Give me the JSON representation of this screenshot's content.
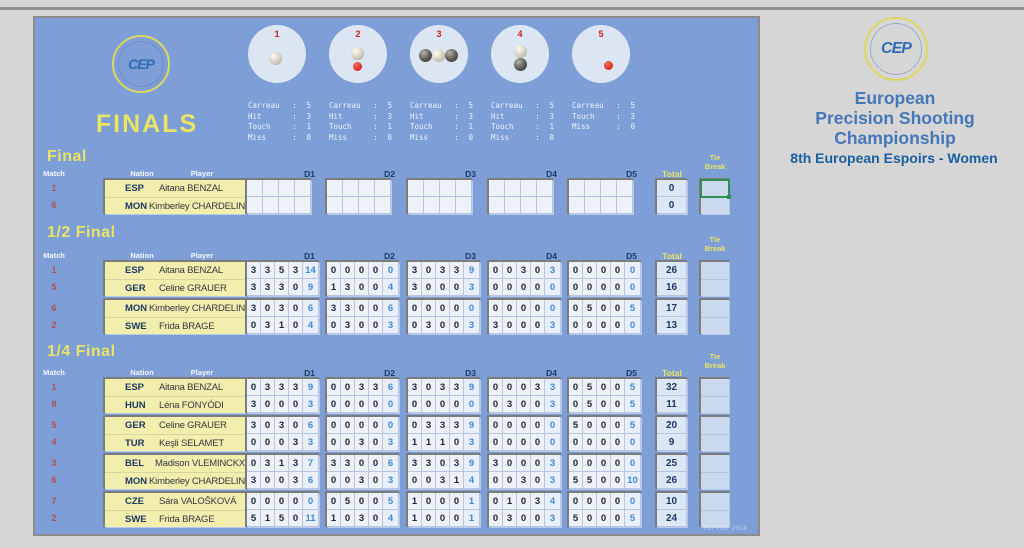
{
  "window": {
    "watermark": "MJPYGG_2024"
  },
  "board": {
    "title": "FINALS",
    "logo_text": "CEP"
  },
  "colors": {
    "board_bg": "#7d9ed6",
    "accent_yellow": "#e9e464",
    "navy": "#1f3864",
    "score_blue": "#4088d8",
    "match_red": "#b25050",
    "selection_green": "#2f8f4f",
    "player_bg": "#f2efae"
  },
  "targets": {
    "circles": [
      {
        "number": "1",
        "balls": [
          {
            "type": "light",
            "dx": -2,
            "dy": 4
          }
        ],
        "stats": [
          [
            "Carreau",
            "5"
          ],
          [
            "Hit",
            "3"
          ],
          [
            "Touch",
            "1"
          ],
          [
            "Miss",
            "0"
          ]
        ]
      },
      {
        "number": "2",
        "balls": [
          {
            "type": "light",
            "dx": -1,
            "dy": -1
          },
          {
            "type": "jack",
            "dx": -1,
            "dy": 12
          }
        ],
        "stats": [
          [
            "Carreau",
            "5"
          ],
          [
            "Hit",
            "3"
          ],
          [
            "Touch",
            "1"
          ],
          [
            "Miss",
            "0"
          ]
        ]
      },
      {
        "number": "3",
        "balls": [
          {
            "type": "dark",
            "dx": -14,
            "dy": 1
          },
          {
            "type": "dark",
            "dx": 12,
            "dy": 1
          },
          {
            "type": "light",
            "dx": -1,
            "dy": 1
          }
        ],
        "stats": [
          [
            "Carreau",
            "5"
          ],
          [
            "Hit",
            "3"
          ],
          [
            "Touch",
            "1"
          ],
          [
            "Miss",
            "0"
          ]
        ]
      },
      {
        "number": "4",
        "balls": [
          {
            "type": "light",
            "dx": 0,
            "dy": -3
          },
          {
            "type": "dark",
            "dx": 0,
            "dy": 10
          }
        ],
        "stats": [
          [
            "Carreau",
            "5"
          ],
          [
            "Hit",
            "3"
          ],
          [
            "Touch",
            "1"
          ],
          [
            "Miss",
            "0"
          ]
        ]
      },
      {
        "number": "5",
        "balls": [
          {
            "type": "jack",
            "dx": 7,
            "dy": 11
          }
        ],
        "stats": [
          [
            "Carreau",
            "5"
          ],
          [
            "",
            ""
          ],
          [
            "Touch",
            "3"
          ],
          [
            "Miss",
            "0"
          ]
        ]
      }
    ]
  },
  "header_right": {
    "logo_text": "CEP",
    "title_lines": [
      "European",
      "Precision Shooting",
      "Championship"
    ],
    "subtitle": "8th European Espoirs - Women"
  },
  "columns": {
    "match": "Match",
    "nation": "Nation",
    "player": "Player",
    "ends": [
      "D1",
      "D2",
      "D3",
      "D4",
      "D5"
    ],
    "total": "Total",
    "tie_break": [
      "Tie",
      "Break"
    ]
  },
  "sections": [
    {
      "title": "Final",
      "empty_ends": true,
      "pairs": [
        {
          "tie_selected": true,
          "rows": [
            {
              "match": "1",
              "nation": "ESP",
              "player": "Aitana BENZAL",
              "total": "0"
            },
            {
              "match": "6",
              "nation": "MON",
              "player": "Kimberley CHARDELIN",
              "total": "0"
            }
          ]
        }
      ]
    },
    {
      "title": "1/2 Final",
      "empty_ends": false,
      "pairs": [
        {
          "tie_selected": false,
          "rows": [
            {
              "match": "1",
              "nation": "ESP",
              "player": "Aitana BENZAL",
              "ends": [
                [
                  3,
                  3,
                  5,
                  3
                ],
                [
                  0,
                  0,
                  0,
                  0
                ],
                [
                  3,
                  0,
                  3,
                  3
                ],
                [
                  0,
                  0,
                  3,
                  0
                ],
                [
                  0,
                  0,
                  0,
                  0
                ]
              ],
              "sums": [
                14,
                0,
                9,
                3,
                0
              ],
              "total": 26
            },
            {
              "match": "5",
              "nation": "GER",
              "player": "Celine GRAUER",
              "ends": [
                [
                  3,
                  3,
                  3,
                  0
                ],
                [
                  1,
                  3,
                  0,
                  0
                ],
                [
                  3,
                  0,
                  0,
                  0
                ],
                [
                  0,
                  0,
                  0,
                  0
                ],
                [
                  0,
                  0,
                  0,
                  0
                ]
              ],
              "sums": [
                9,
                4,
                3,
                0,
                0
              ],
              "total": 16
            }
          ]
        },
        {
          "tie_selected": false,
          "rows": [
            {
              "match": "6",
              "nation": "MON",
              "player": "Kimberley CHARDELIN",
              "ends": [
                [
                  3,
                  0,
                  3,
                  0
                ],
                [
                  3,
                  3,
                  0,
                  0
                ],
                [
                  0,
                  0,
                  0,
                  0
                ],
                [
                  0,
                  0,
                  0,
                  0
                ],
                [
                  0,
                  5,
                  0,
                  0
                ]
              ],
              "sums": [
                6,
                6,
                0,
                0,
                5
              ],
              "total": 17
            },
            {
              "match": "2",
              "nation": "SWE",
              "player": "Frida BRAGE",
              "ends": [
                [
                  0,
                  3,
                  1,
                  0
                ],
                [
                  0,
                  3,
                  0,
                  0
                ],
                [
                  0,
                  3,
                  0,
                  0
                ],
                [
                  3,
                  0,
                  0,
                  0
                ],
                [
                  0,
                  0,
                  0,
                  0
                ]
              ],
              "sums": [
                4,
                3,
                3,
                3,
                0
              ],
              "total": 13
            }
          ]
        }
      ]
    },
    {
      "title": "1/4 Final",
      "empty_ends": false,
      "pairs": [
        {
          "tie_selected": false,
          "rows": [
            {
              "match": "1",
              "nation": "ESP",
              "player": "Aitana BENZAL",
              "ends": [
                [
                  0,
                  3,
                  3,
                  3
                ],
                [
                  0,
                  0,
                  3,
                  3
                ],
                [
                  3,
                  0,
                  3,
                  3
                ],
                [
                  0,
                  0,
                  0,
                  3
                ],
                [
                  0,
                  5,
                  0,
                  0
                ]
              ],
              "sums": [
                9,
                6,
                9,
                3,
                5
              ],
              "total": 32
            },
            {
              "match": "8",
              "nation": "HUN",
              "player": "Léna FONYÓDI",
              "ends": [
                [
                  3,
                  0,
                  0,
                  0
                ],
                [
                  0,
                  0,
                  0,
                  0
                ],
                [
                  0,
                  0,
                  0,
                  0
                ],
                [
                  0,
                  3,
                  0,
                  0
                ],
                [
                  0,
                  5,
                  0,
                  0
                ]
              ],
              "sums": [
                3,
                0,
                0,
                3,
                5
              ],
              "total": 11
            }
          ]
        },
        {
          "tie_selected": false,
          "rows": [
            {
              "match": "5",
              "nation": "GER",
              "player": "Celine GRAUER",
              "ends": [
                [
                  3,
                  0,
                  3,
                  0
                ],
                [
                  0,
                  0,
                  0,
                  0
                ],
                [
                  0,
                  3,
                  3,
                  3
                ],
                [
                  0,
                  0,
                  0,
                  0
                ],
                [
                  5,
                  0,
                  0,
                  0
                ]
              ],
              "sums": [
                6,
                0,
                9,
                0,
                5
              ],
              "total": 20
            },
            {
              "match": "4",
              "nation": "TUR",
              "player": "Keşli SELAMET",
              "ends": [
                [
                  0,
                  0,
                  0,
                  3
                ],
                [
                  0,
                  0,
                  3,
                  0
                ],
                [
                  1,
                  1,
                  1,
                  0
                ],
                [
                  0,
                  0,
                  0,
                  0
                ],
                [
                  0,
                  0,
                  0,
                  0
                ]
              ],
              "sums": [
                3,
                3,
                3,
                0,
                0
              ],
              "total": 9
            }
          ]
        },
        {
          "tie_selected": false,
          "rows": [
            {
              "match": "3",
              "nation": "BEL",
              "player": "Madison VLEMINCKX",
              "ends": [
                [
                  0,
                  3,
                  1,
                  3
                ],
                [
                  3,
                  3,
                  0,
                  0
                ],
                [
                  3,
                  3,
                  0,
                  3
                ],
                [
                  3,
                  0,
                  0,
                  0
                ],
                [
                  0,
                  0,
                  0,
                  0
                ]
              ],
              "sums": [
                7,
                6,
                9,
                3,
                0
              ],
              "total": 25
            },
            {
              "match": "6",
              "nation": "MON",
              "player": "Kimberley CHARDELIN",
              "ends": [
                [
                  3,
                  0,
                  0,
                  3
                ],
                [
                  0,
                  0,
                  3,
                  0
                ],
                [
                  0,
                  0,
                  3,
                  1
                ],
                [
                  0,
                  0,
                  3,
                  0
                ],
                [
                  5,
                  5,
                  0,
                  0
                ]
              ],
              "sums": [
                6,
                3,
                4,
                3,
                10
              ],
              "total": 26
            }
          ]
        },
        {
          "tie_selected": false,
          "rows": [
            {
              "match": "7",
              "nation": "CZE",
              "player": "Sára VALOŠKOVÁ",
              "ends": [
                [
                  0,
                  0,
                  0,
                  0
                ],
                [
                  0,
                  5,
                  0,
                  0
                ],
                [
                  1,
                  0,
                  0,
                  0
                ],
                [
                  0,
                  1,
                  0,
                  3
                ],
                [
                  0,
                  0,
                  0,
                  0
                ]
              ],
              "sums": [
                0,
                5,
                1,
                4,
                0
              ],
              "total": 10
            },
            {
              "match": "2",
              "nation": "SWE",
              "player": "Frida BRAGE",
              "ends": [
                [
                  5,
                  1,
                  5,
                  0
                ],
                [
                  1,
                  0,
                  3,
                  0
                ],
                [
                  1,
                  0,
                  0,
                  0
                ],
                [
                  0,
                  3,
                  0,
                  0
                ],
                [
                  5,
                  0,
                  0,
                  0
                ]
              ],
              "sums": [
                11,
                4,
                1,
                3,
                5
              ],
              "total": 24
            }
          ]
        }
      ]
    }
  ]
}
